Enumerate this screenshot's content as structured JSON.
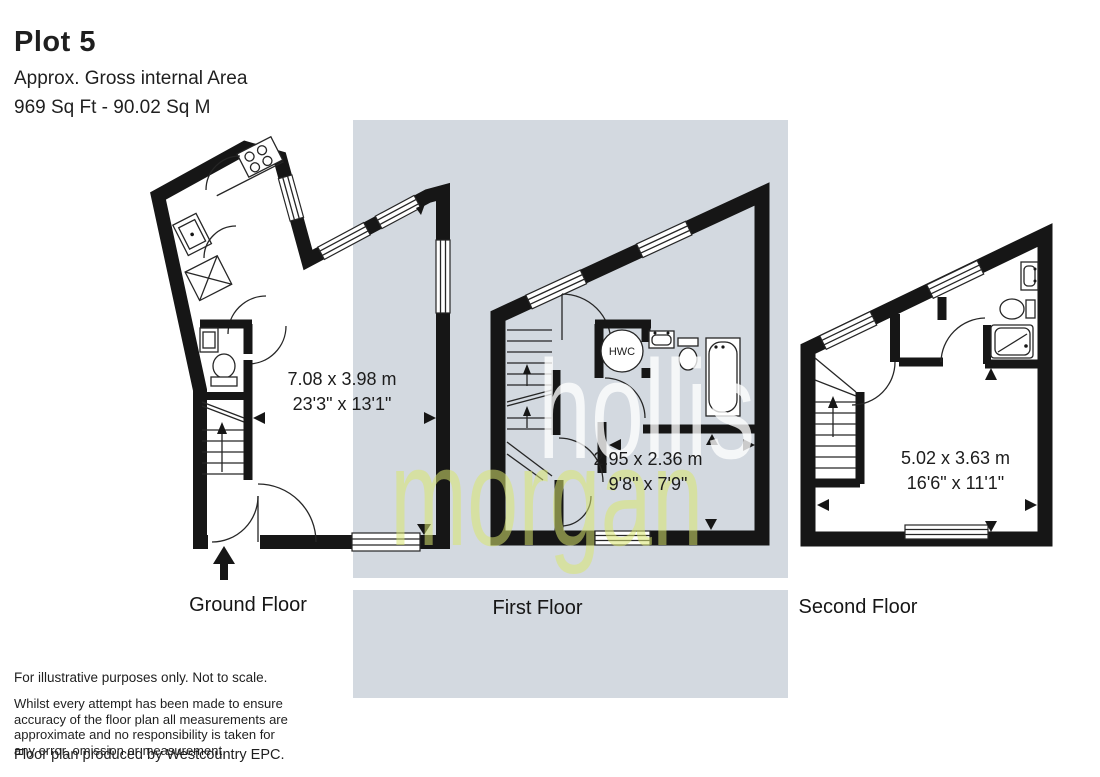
{
  "header": {
    "title": "Plot 5",
    "subtitle": "Approx. Gross internal Area",
    "area": "969 Sq Ft - 90.02 Sq M"
  },
  "floors": {
    "ground": {
      "label": "Ground Floor",
      "dimensions_metric": "7.08 x 3.98 m",
      "dimensions_imperial": "23'3\" x 13'1\""
    },
    "first": {
      "label": "First Floor",
      "dimensions_metric": "2.95 x 2.36 m",
      "dimensions_imperial": "9'8\" x 7'9\"",
      "hwc_label": "HWC"
    },
    "second": {
      "label": "Second Floor",
      "dimensions_metric": "5.02 x 3.63 m",
      "dimensions_imperial": "16'6\" x 11'1\""
    }
  },
  "watermark": {
    "line1": "hollis",
    "line2": "morgan",
    "color_line1": "#ffffff",
    "color_line2": "#d8e670"
  },
  "footer": {
    "note": "For illustrative purposes only. Not to scale.",
    "disclaimer": "Whilst every attempt has been made to ensure accuracy of the floor plan all measurements are approximate and no responsibility is taken for any error, omission or measurement.",
    "produced_by": "Floor plan produced by Westcountry EPC."
  },
  "colors": {
    "background_band": "#d3d9e0",
    "walls": "#161616",
    "text": "#1f1f1f"
  }
}
